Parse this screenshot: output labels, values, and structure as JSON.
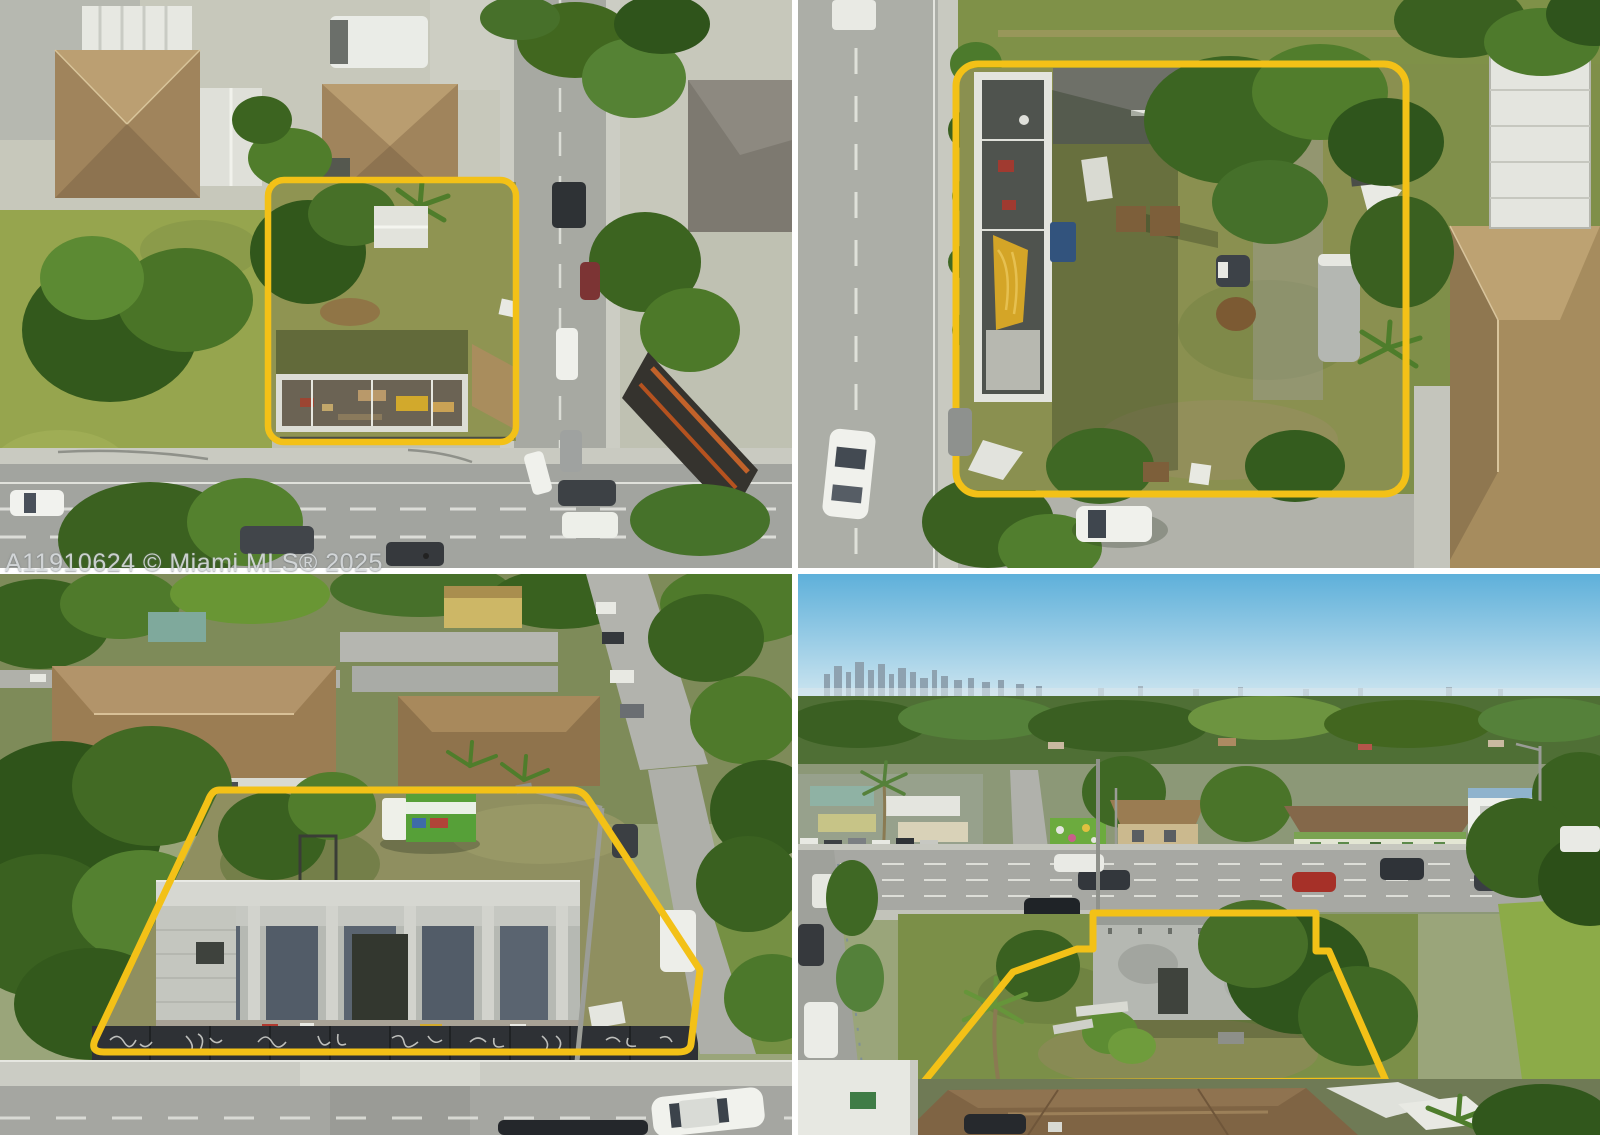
{
  "watermark": {
    "text": "A11910624 © Miami MLS® 2025"
  },
  "colors": {
    "highlight_yellow": "#F3C117",
    "gutter_white": "#FFFFFF"
  },
  "collage": {
    "rows": 2,
    "cols": 2,
    "photos": [
      {
        "id": "top-left",
        "caption": "Top-down aerial: corner lot outlined in yellow with roofless structure beside a wide multi-lane road"
      },
      {
        "id": "top-right",
        "caption": "Close top-down aerial: outlined lot with long roofless building, grass yard, trailer and tree canopy next to a street"
      },
      {
        "id": "bottom-left",
        "caption": "Oblique drone view: outlined lot with unfinished two-story concrete shell behind a graffiti-covered fence"
      },
      {
        "id": "bottom-right",
        "caption": "Oblique drone view across the boulevard toward the outlined lot, Miami skyline on the horizon"
      }
    ]
  }
}
